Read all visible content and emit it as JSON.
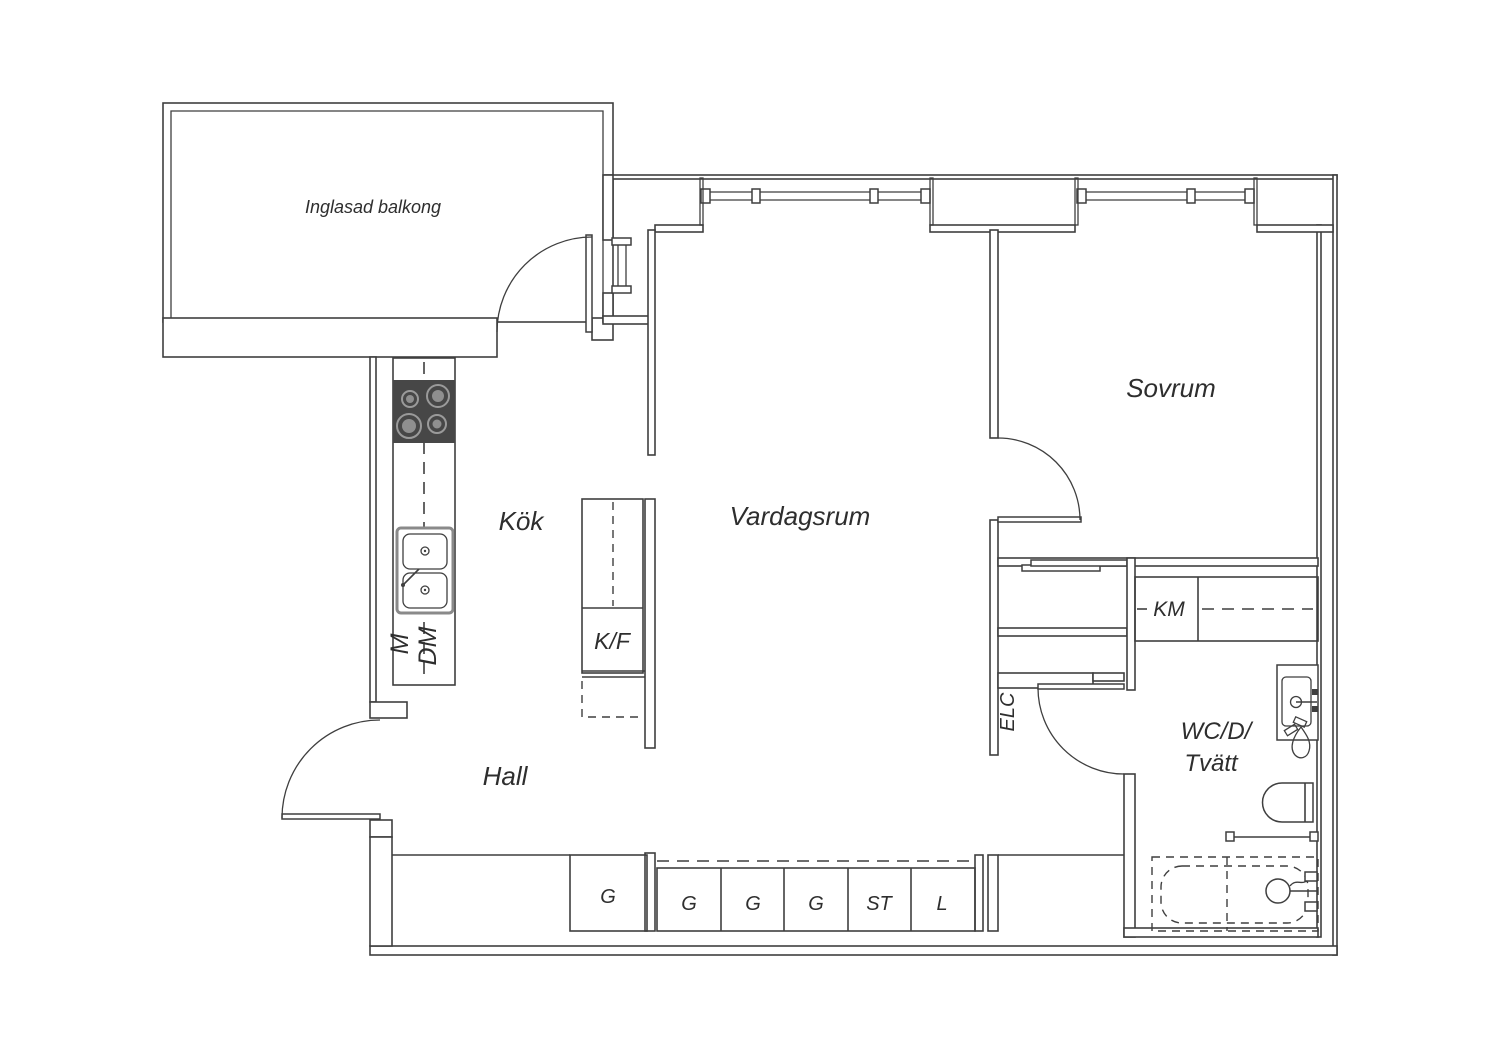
{
  "colors": {
    "line": "#3f3f3f",
    "stove_fill": "#474747",
    "burner_ring": "#9a9a9a",
    "burner_center": "#8f8f8f",
    "sink_frame": "#8a8a8a",
    "text": "#2e2e2e",
    "background": "#ffffff"
  },
  "rooms": {
    "balcony": "Inglasad balkong",
    "kitchen": "Kök",
    "living_room": "Vardagsrum",
    "bedroom": "Sovrum",
    "hall": "Hall",
    "bathroom_line1": "WC/D/",
    "bathroom_line2": "Tvätt"
  },
  "appliances": {
    "fridge_freezer": "K/F",
    "washing_machine": "KM",
    "microwave": "M",
    "dishwasher": "DM",
    "electrical_cabinet": "ELC"
  },
  "storage": {
    "single_wardrobe": "G",
    "bank_cells": [
      "G",
      "G",
      "G",
      "ST",
      "L"
    ]
  }
}
